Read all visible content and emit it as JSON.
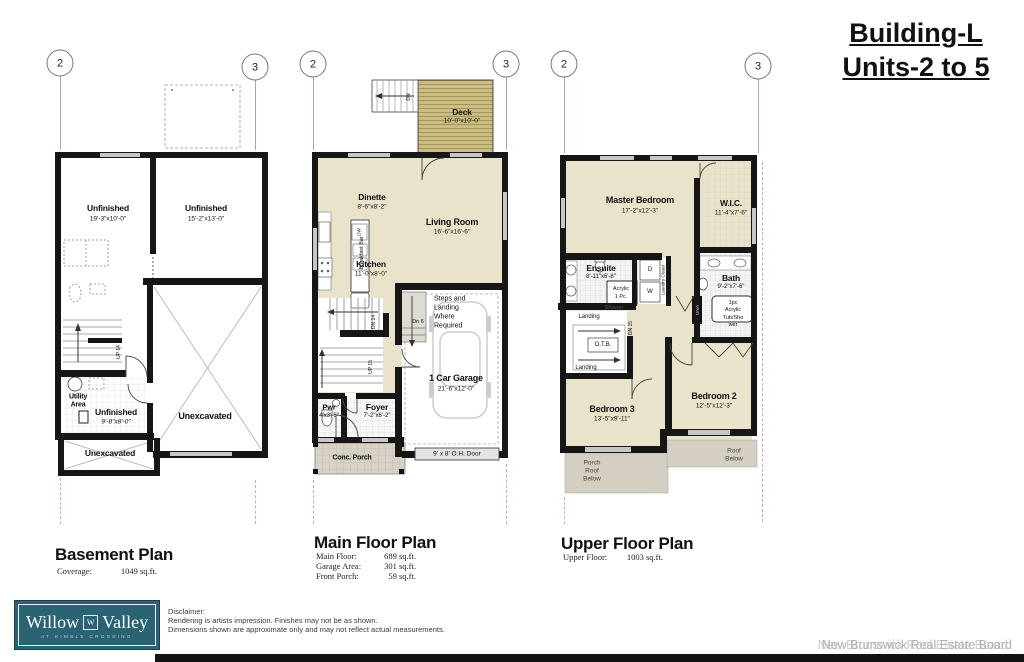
{
  "title": {
    "line1": "Building-L",
    "line2": "Units-2 to 5"
  },
  "markers": {
    "left": "2",
    "right": "3"
  },
  "basement": {
    "title": "Basement Plan",
    "stats": [
      {
        "label": "Coverage:",
        "value": "1049 sq.ft."
      }
    ],
    "labels": {
      "unf1_name": "Unfinished",
      "unf1_dims": "19'-3\"x10'-0\"",
      "unf2_name": "Unfinished",
      "unf2_dims": "15'-2\"x13'-0\"",
      "utility_l1": "Utility",
      "utility_l2": "Area",
      "unf3_name": "Unfinished",
      "unf3_dims": "9'-8\"x8'-0\"",
      "unexcavated_right": "Unexcavated",
      "unexcavated_bottom": "Unexcavated",
      "up14": "UP 14"
    }
  },
  "main": {
    "title": "Main Floor Plan",
    "stats": [
      {
        "label": "Main Floor:",
        "value": "689 sq.ft."
      },
      {
        "label": "Garage Area:",
        "value": "301 sq.ft."
      },
      {
        "label": "Front Porch:",
        "value": "59 sq.ft."
      }
    ],
    "labels": {
      "deck_name": "Deck",
      "deck_dims": "10'-0\"x10'-0\"",
      "deck_dn": "DN",
      "dinette_name": "Dinette",
      "dinette_dims": "8'-6\"x8'-2\"",
      "living_name": "Living Room",
      "living_dims": "16'-6\"x16'-6\"",
      "breakfast_bar": "Breakfast Bar",
      "dw": "DW",
      "kitchen_name": "Kitchen",
      "kitchen_dims": "11'-0\"x8'-0\"",
      "steps_l1": "Steps and",
      "steps_l2": "Landing",
      "steps_l3": "Where",
      "steps_l4": "Required",
      "dn6": "Dn 6",
      "dn14": "DN 14",
      "up15": "UP 15",
      "garage_name": "1 Car Garage",
      "garage_dims": "21'-6\"x12'-0\"",
      "pwr_name": "Pwr",
      "pwr_dims": "4'x3'-6\"",
      "foyer_name": "Foyer",
      "foyer_dims": "7'-2\"x6'-2\"",
      "oh_door": "9' x 8' O.H. Door",
      "porch": "Conc. Porch"
    }
  },
  "upper": {
    "title": "Upper Floor Plan",
    "stats": [
      {
        "label": "Upper Floor:",
        "value": "1003 sq.ft."
      }
    ],
    "labels": {
      "master_name": "Master Bedroom",
      "master_dims": "17'-2\"x12'-3\"",
      "wic_name": "W.I.C.",
      "wic_dims": "11'-4\"x7'-6\"",
      "ensuite_name": "Ensuite",
      "ensuite_dims": "8'-11\"x6'-8\"",
      "shower_l1": "Acrylic",
      "shower_l2": "1 Pc.",
      "shower_l3": "Shower",
      "d": "D",
      "w": "W",
      "laundry": "Laundry Closet",
      "bath_name": "Bath",
      "bath_dims": "9'-2\"x7'-6\"",
      "tub_l1": "1pc",
      "tub_l2": "Acrylic",
      "tub_l3": "Tub/Sho",
      "tub_l4": "wer",
      "linen": "Linen",
      "landing_top": "Landing",
      "otb": "O.T.B.",
      "dn15": "DN 15",
      "landing_bottom": "Landing",
      "bed2_name": "Bedroom 2",
      "bed2_dims": "12'-5\"x12'-3\"",
      "bed3_name": "Bedroom 3",
      "bed3_dims": "13'-5\"x9'-11\"",
      "porch_roof_l1": "Porch",
      "porch_roof_l2": "Roof",
      "porch_roof_l3": "Below",
      "roof_l1": "Roof",
      "roof_l2": "Below"
    }
  },
  "logo": {
    "word1": "Willow",
    "word2": "Valley",
    "monogram": "W",
    "tagline": "AT KIMBLE CROSSING"
  },
  "disclaimer": {
    "l1": "Disclaimer:",
    "l2": "Rendering is artists impression.  Finishes may not be as shown.",
    "l3": "Dimensions shown are approximate only and may not reflect actual measurements."
  },
  "footer": {
    "board": "New Brunswick Real Estate Board"
  },
  "colors": {
    "floor_beige": "#EAE3CC",
    "deck_tan": "#CBBE82",
    "wall_black": "#161616",
    "window_gray": "#C6C6C6",
    "roof_gray": "#D5CFC3",
    "porch_gray": "#D8D2C6",
    "logo_teal": "#2A6374",
    "marker_line": "#C49C9C"
  }
}
